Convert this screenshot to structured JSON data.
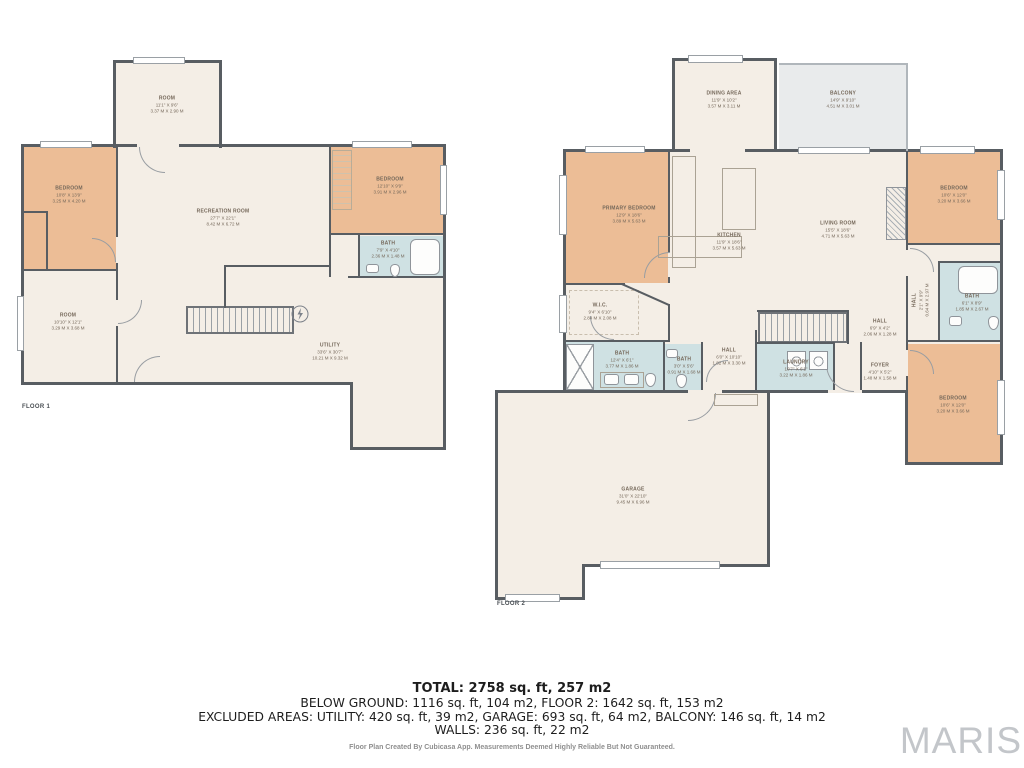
{
  "watermark": "MARIS",
  "summary": {
    "total": "TOTAL: 2758 sq. ft, 257 m2",
    "line2": "BELOW GROUND: 1116 sq. ft, 104 m2, FLOOR 2: 1642 sq. ft, 153 m2",
    "line3": "EXCLUDED AREAS: UTILITY: 420 sq. ft, 39 m2, GARAGE: 693 sq. ft, 64 m2, BALCONY: 146 sq. ft, 14 m2",
    "line4": "WALLS: 236 sq. ft, 22 m2",
    "disclaimer": "Floor Plan Created By Cubicasa App. Measurements Deemed Highly Reliable But Not Guaranteed."
  },
  "colors": {
    "wall": "#585d62",
    "room_cream": "#f4eee6",
    "bedroom_orange": "#ecbd96",
    "bath_blue": "#cfe1e3",
    "balcony_gray": "#e9ebec",
    "label_text": "#75685a"
  },
  "floor1": {
    "label": "FLOOR 1",
    "rooms": [
      {
        "name": "ROOM",
        "imperial": "11'1\" X 9'6\"",
        "metric": "3.37 M X 2.90 M"
      },
      {
        "name": "BEDROOM",
        "imperial": "10'8\" X 13'9\"",
        "metric": "3.25 M X 4.20 M"
      },
      {
        "name": "RECREATION ROOM",
        "imperial": "27'7\" X 22'1\"",
        "metric": "8.42 M X 6.72 M"
      },
      {
        "name": "BEDROOM",
        "imperial": "12'10\" X 9'9\"",
        "metric": "3.91 M X 2.96 M"
      },
      {
        "name": "BATH",
        "imperial": "7'9\" X 4'10\"",
        "metric": "2.36 M X 1.48 M"
      },
      {
        "name": "ROOM",
        "imperial": "10'10\" X 12'1\"",
        "metric": "3.29 M X 3.68 M"
      },
      {
        "name": "UTILITY",
        "imperial": "33'6\" X 30'7\"",
        "metric": "10.21 M X 9.32 M"
      }
    ]
  },
  "floor2": {
    "label": "FLOOR 2",
    "rooms": [
      {
        "name": "DINING AREA",
        "imperial": "11'9\" X 10'2\"",
        "metric": "3.57 M X 3.11 M"
      },
      {
        "name": "BALCONY",
        "imperial": "14'9\" X 9'10\"",
        "metric": "4.51 M X 3.01 M"
      },
      {
        "name": "PRIMARY BEDROOM",
        "imperial": "12'9\" X 18'6\"",
        "metric": "3.89 M X 5.63 M"
      },
      {
        "name": "KITCHEN",
        "imperial": "11'9\" X 18'6\"",
        "metric": "3.57 M X 5.63 M"
      },
      {
        "name": "LIVING ROOM",
        "imperial": "15'5\" X 18'6\"",
        "metric": "4.71 M X 5.63 M"
      },
      {
        "name": "BEDROOM",
        "imperial": "10'6\" X 12'0\"",
        "metric": "3.20 M X 3.66 M"
      },
      {
        "name": "W.I.C.",
        "imperial": "9'4\" X 6'10\"",
        "metric": "2.84 M X 2.08 M"
      },
      {
        "name": "BATH",
        "imperial": "12'4\" X 6'1\"",
        "metric": "3.77 M X 1.86 M"
      },
      {
        "name": "BATH",
        "imperial": "3'0\" X 5'6\"",
        "metric": "0.91 M X 1.68 M"
      },
      {
        "name": "HALL",
        "imperial": "6'0\" X 10'10\"",
        "metric": "1.82 M X 3.30 M"
      },
      {
        "name": "LAUNDRY",
        "imperial": "10'7\" X 6'1\"",
        "metric": "3.22 M X 1.86 M"
      },
      {
        "name": "HALL",
        "imperial": "6'9\" X 4'2\"",
        "metric": "2.06 M X 1.28 M"
      },
      {
        "name": "FOYER",
        "imperial": "4'10\" X 5'2\"",
        "metric": "1.48 M X 1.58 M"
      },
      {
        "name": "BATH",
        "imperial": "6'1\" X 8'9\"",
        "metric": "1.85 M X 2.67 M"
      },
      {
        "name": "BEDROOM",
        "imperial": "10'6\" X 12'0\"",
        "metric": "3.20 M X 3.66 M"
      },
      {
        "name": "GARAGE",
        "imperial": "31'0\" X 22'10\"",
        "metric": "9.45 M X 6.96 M"
      },
      {
        "name": "HALL",
        "imperial": "2'1\" X 9'9\"",
        "metric": "0.64 M X 2.97 M"
      }
    ]
  }
}
